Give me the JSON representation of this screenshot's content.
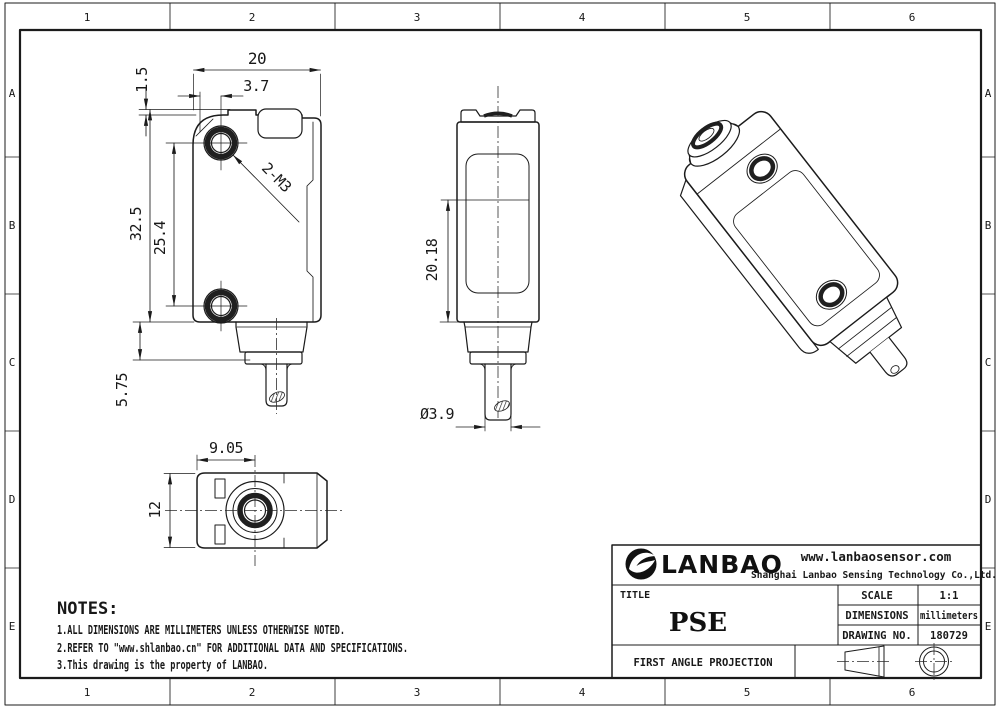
{
  "drawing": {
    "border": {
      "cols": [
        "1",
        "2",
        "3",
        "4",
        "5",
        "6"
      ],
      "rows": [
        "A",
        "B",
        "C",
        "D",
        "E"
      ]
    },
    "front_view": {
      "width": "20",
      "hole_offset": "3.7",
      "lip_height": "1.5",
      "body_height": "32.5",
      "hole_pitch": "25.4",
      "gland_height": "5.75",
      "thread_callout": "2-M3"
    },
    "side_view": {
      "optical_height": "20.18",
      "cable_diameter": "Ø3.9"
    },
    "bottom_view": {
      "lens_offset": "9.05",
      "depth": "12"
    },
    "notes": {
      "heading": "NOTES:",
      "items": [
        "1.ALL DIMENSIONS ARE MILLIMETERS UNLESS OTHERWISE NOTED.",
        "2.REFER TO \"www.shlanbao.cn\" FOR ADDITIONAL DATA AND SPECIFICATIONS.",
        "3.This drawing is the property of LANBAO."
      ]
    },
    "title_block": {
      "brand": "LANBAO",
      "website": "www.lanbaosensor.com",
      "company": "Shanghai Lanbao Sensing Technology Co.,Ltd.",
      "title_label": "TITLE",
      "title": "PSE",
      "specs": [
        {
          "label": "SCALE",
          "value": "1:1"
        },
        {
          "label": "DIMENSIONS",
          "value": "millimeters"
        },
        {
          "label": "DRAWING NO.",
          "value": "180729"
        }
      ],
      "projection_label": "FIRST ANGLE PROJECTION"
    }
  }
}
